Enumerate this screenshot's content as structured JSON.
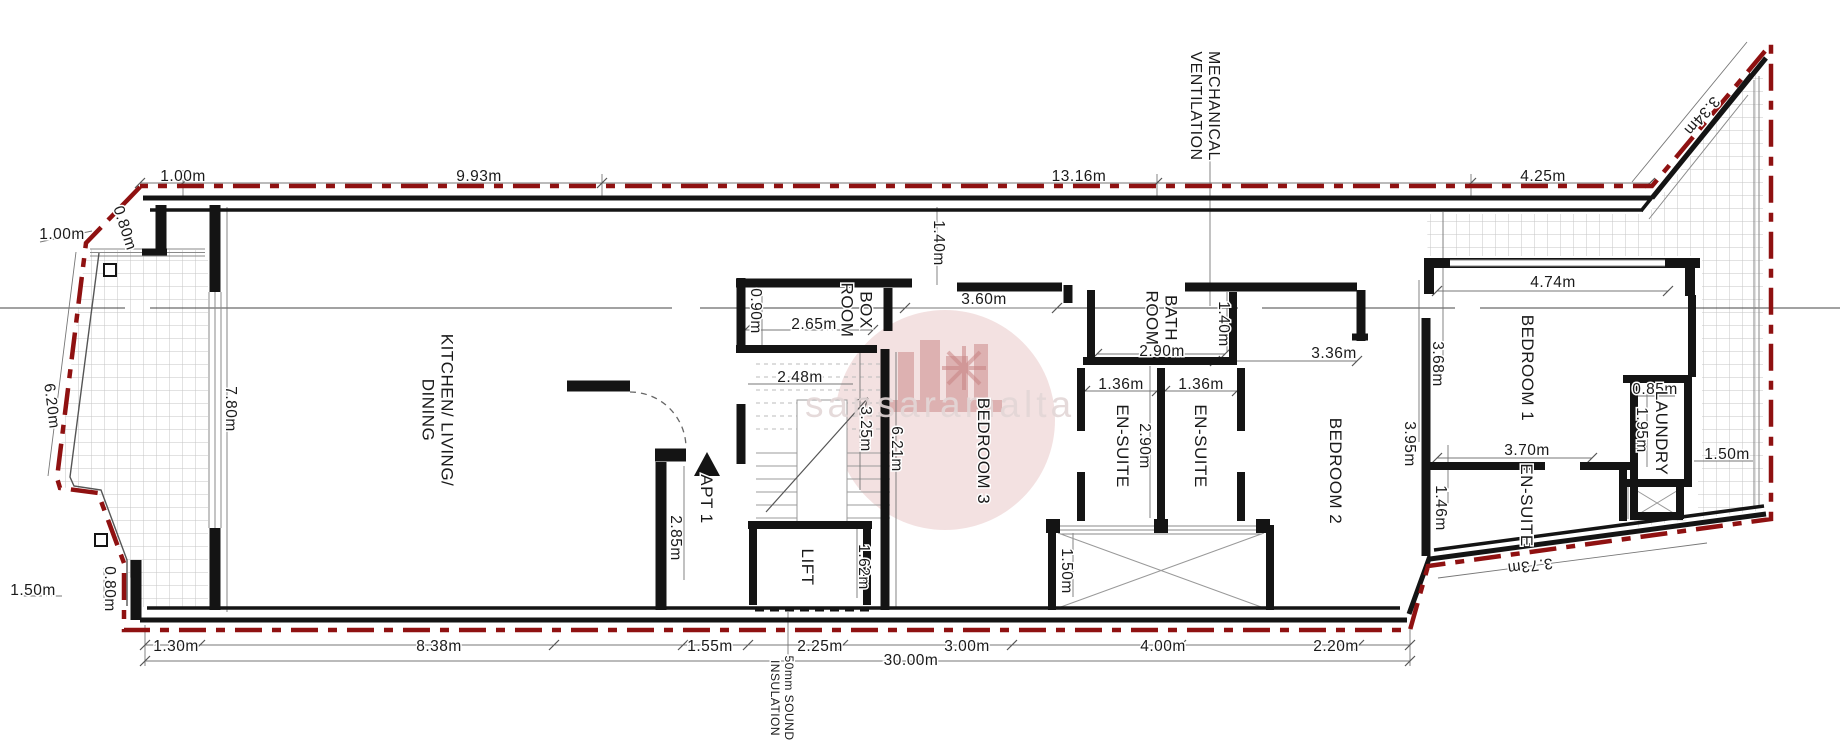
{
  "watermark": {
    "text": "sansaramalta"
  },
  "colors": {
    "boundary_red": "#8f1111",
    "wall_black": "#141414",
    "dim_gray": "#777777",
    "tile_gray": "#c6c6c6",
    "watermark_pink": "#c98383",
    "text": "#1a1a1a"
  },
  "dimensions": [
    {
      "id": "dim-top-left-offset",
      "text": "1.00m",
      "x": 183,
      "y": 176
    },
    {
      "id": "dim-top-kitchen",
      "text": "9.93m",
      "x": 479,
      "y": 176
    },
    {
      "id": "dim-top-corridor",
      "text": "13.16m",
      "x": 1079,
      "y": 176
    },
    {
      "id": "dim-top-right",
      "text": "4.25m",
      "x": 1543,
      "y": 176
    },
    {
      "id": "dim-diag-top-right",
      "text": "3.34m",
      "x": 1702,
      "y": 116,
      "rot": 131
    },
    {
      "id": "dim-left-corner",
      "text": "1.00m",
      "x": 62,
      "y": 234
    },
    {
      "id": "dim-left-step",
      "text": "0.80m",
      "x": 125,
      "y": 228,
      "rot": 72
    },
    {
      "id": "dim-left-slant",
      "text": "6.20m",
      "x": 52,
      "y": 406,
      "rot": 83
    },
    {
      "id": "dim-left-kitchen",
      "text": "7.80m",
      "x": 231,
      "y": 409,
      "rot": 90
    },
    {
      "id": "dim-bottom-left-corner",
      "text": "1.50m",
      "x": 33,
      "y": 590
    },
    {
      "id": "dim-bottom-left-step",
      "text": "0.80m",
      "x": 110,
      "y": 589,
      "rot": 90
    },
    {
      "id": "dim-bottom-terrace",
      "text": "1.30m",
      "x": 176,
      "y": 646
    },
    {
      "id": "dim-bottom-kitchen",
      "text": "8.38m",
      "x": 439,
      "y": 646
    },
    {
      "id": "dim-bottom-hall",
      "text": "1.55m",
      "x": 710,
      "y": 646
    },
    {
      "id": "dim-bottom-lift",
      "text": "2.25m",
      "x": 820,
      "y": 646
    },
    {
      "id": "dim-bottom-bed3",
      "text": "3.00m",
      "x": 967,
      "y": 646
    },
    {
      "id": "dim-bottom-shaft",
      "text": "4.00m",
      "x": 1163,
      "y": 646
    },
    {
      "id": "dim-bottom-bed2",
      "text": "2.20m",
      "x": 1336,
      "y": 646
    },
    {
      "id": "dim-bottom-total",
      "text": "30.00m",
      "x": 911,
      "y": 660
    },
    {
      "id": "dim-diag-bottom-right",
      "text": "3.73m",
      "x": 1530,
      "y": 566,
      "rot": 173
    },
    {
      "id": "dim-box-width",
      "text": "2.65m",
      "x": 814,
      "y": 324
    },
    {
      "id": "dim-box-height",
      "text": "0.90m",
      "x": 756,
      "y": 311,
      "rot": 90
    },
    {
      "id": "dim-stair-width",
      "text": "2.48m",
      "x": 800,
      "y": 377
    },
    {
      "id": "dim-stair-height",
      "text": "3.25m",
      "x": 866,
      "y": 429,
      "rot": 90
    },
    {
      "id": "dim-hall-height",
      "text": "6.21m",
      "x": 897,
      "y": 449,
      "rot": 90
    },
    {
      "id": "dim-entry-height",
      "text": "2.85m",
      "x": 676,
      "y": 538,
      "rot": 90
    },
    {
      "id": "dim-lift-height",
      "text": "1.62m",
      "x": 864,
      "y": 567,
      "rot": 90
    },
    {
      "id": "dim-corridor-width",
      "text": "1.40m",
      "x": 939,
      "y": 243,
      "rot": 90
    },
    {
      "id": "dim-bed3-width",
      "text": "3.60m",
      "x": 984,
      "y": 299
    },
    {
      "id": "dim-bath-width",
      "text": "2.90m",
      "x": 1162,
      "y": 351
    },
    {
      "id": "dim-bath-depth",
      "text": "1.40m",
      "x": 1224,
      "y": 324,
      "rot": 90
    },
    {
      "id": "dim-ensuite1-width",
      "text": "1.36m",
      "x": 1121,
      "y": 384
    },
    {
      "id": "dim-ensuite2-width",
      "text": "1.36m",
      "x": 1201,
      "y": 384
    },
    {
      "id": "dim-ensuite-depth",
      "text": "2.90m",
      "x": 1145,
      "y": 446,
      "rot": 90
    },
    {
      "id": "dim-bed2-width",
      "text": "3.36m",
      "x": 1334,
      "y": 353
    },
    {
      "id": "dim-bed2-left",
      "text": "3.95m",
      "x": 1410,
      "y": 444,
      "rot": 90
    },
    {
      "id": "dim-bed1-left",
      "text": "3.68m",
      "x": 1438,
      "y": 364,
      "rot": 90
    },
    {
      "id": "dim-ensuite3-left",
      "text": "1.46m",
      "x": 1441,
      "y": 508,
      "rot": 90
    },
    {
      "id": "dim-bed1-width",
      "text": "4.74m",
      "x": 1553,
      "y": 282
    },
    {
      "id": "dim-bed1-bottom",
      "text": "3.70m",
      "x": 1527,
      "y": 450
    },
    {
      "id": "dim-laundry-width",
      "text": "0.85m",
      "x": 1655,
      "y": 389
    },
    {
      "id": "dim-laundry-height",
      "text": "1.95m",
      "x": 1642,
      "y": 430,
      "rot": 90
    },
    {
      "id": "dim-terrace-right",
      "text": "1.50m",
      "x": 1727,
      "y": 454
    },
    {
      "id": "dim-shaft-height",
      "text": "1.50m",
      "x": 1067,
      "y": 571,
      "rot": 90
    }
  ],
  "rooms": [
    {
      "id": "room-kitchen",
      "lines": [
        "KITCHEN/ LIVING/",
        "DINING"
      ],
      "x": 437,
      "y": 410,
      "rot": 90,
      "fs": 17
    },
    {
      "id": "room-box",
      "lines": [
        "BOX",
        "ROOM"
      ],
      "x": 856,
      "y": 310,
      "rot": 90,
      "fs": 17
    },
    {
      "id": "room-bed3",
      "text": "BEDROOM 3",
      "x": 983,
      "y": 451,
      "rot": 90,
      "fs": 17
    },
    {
      "id": "room-bath",
      "lines": [
        "BATH",
        "ROOM"
      ],
      "x": 1161,
      "y": 318,
      "rot": 90,
      "fs": 17
    },
    {
      "id": "room-ensuite1",
      "text": "EN-SUITE",
      "x": 1122,
      "y": 446,
      "rot": 90,
      "fs": 17
    },
    {
      "id": "room-ensuite2",
      "text": "EN-SUITE",
      "x": 1200,
      "y": 446,
      "rot": 90,
      "fs": 17
    },
    {
      "id": "room-bed2",
      "text": "BEDROOM 2",
      "x": 1335,
      "y": 471,
      "rot": 90,
      "fs": 17
    },
    {
      "id": "room-bed1",
      "text": "BEDROOM 1",
      "x": 1527,
      "y": 368,
      "rot": 90,
      "fs": 17
    },
    {
      "id": "room-ensuite3",
      "text": "EN-SUITE",
      "x": 1526,
      "y": 505,
      "rot": 90,
      "fs": 17
    },
    {
      "id": "room-laundry",
      "text": "LAUNDRY",
      "x": 1661,
      "y": 433,
      "rot": 90,
      "fs": 17
    },
    {
      "id": "room-lift",
      "text": "LIFT",
      "x": 807,
      "y": 567,
      "rot": 90,
      "fs": 17
    }
  ],
  "annotations": [
    {
      "id": "label-apt1",
      "text": "APT 1",
      "x": 706,
      "y": 499,
      "rot": 90,
      "fs": 17
    },
    {
      "id": "note-mechanical-ventilation",
      "lines": [
        "MECHANICAL",
        "VENTILATION"
      ],
      "x": 1205,
      "y": 106,
      "rot": 90,
      "fs": 16
    },
    {
      "id": "note-sound-insulation",
      "lines": [
        "50mm SOUND",
        "INSULATION"
      ],
      "x": 783,
      "y": 698,
      "rot": 90,
      "fs": 12
    }
  ]
}
